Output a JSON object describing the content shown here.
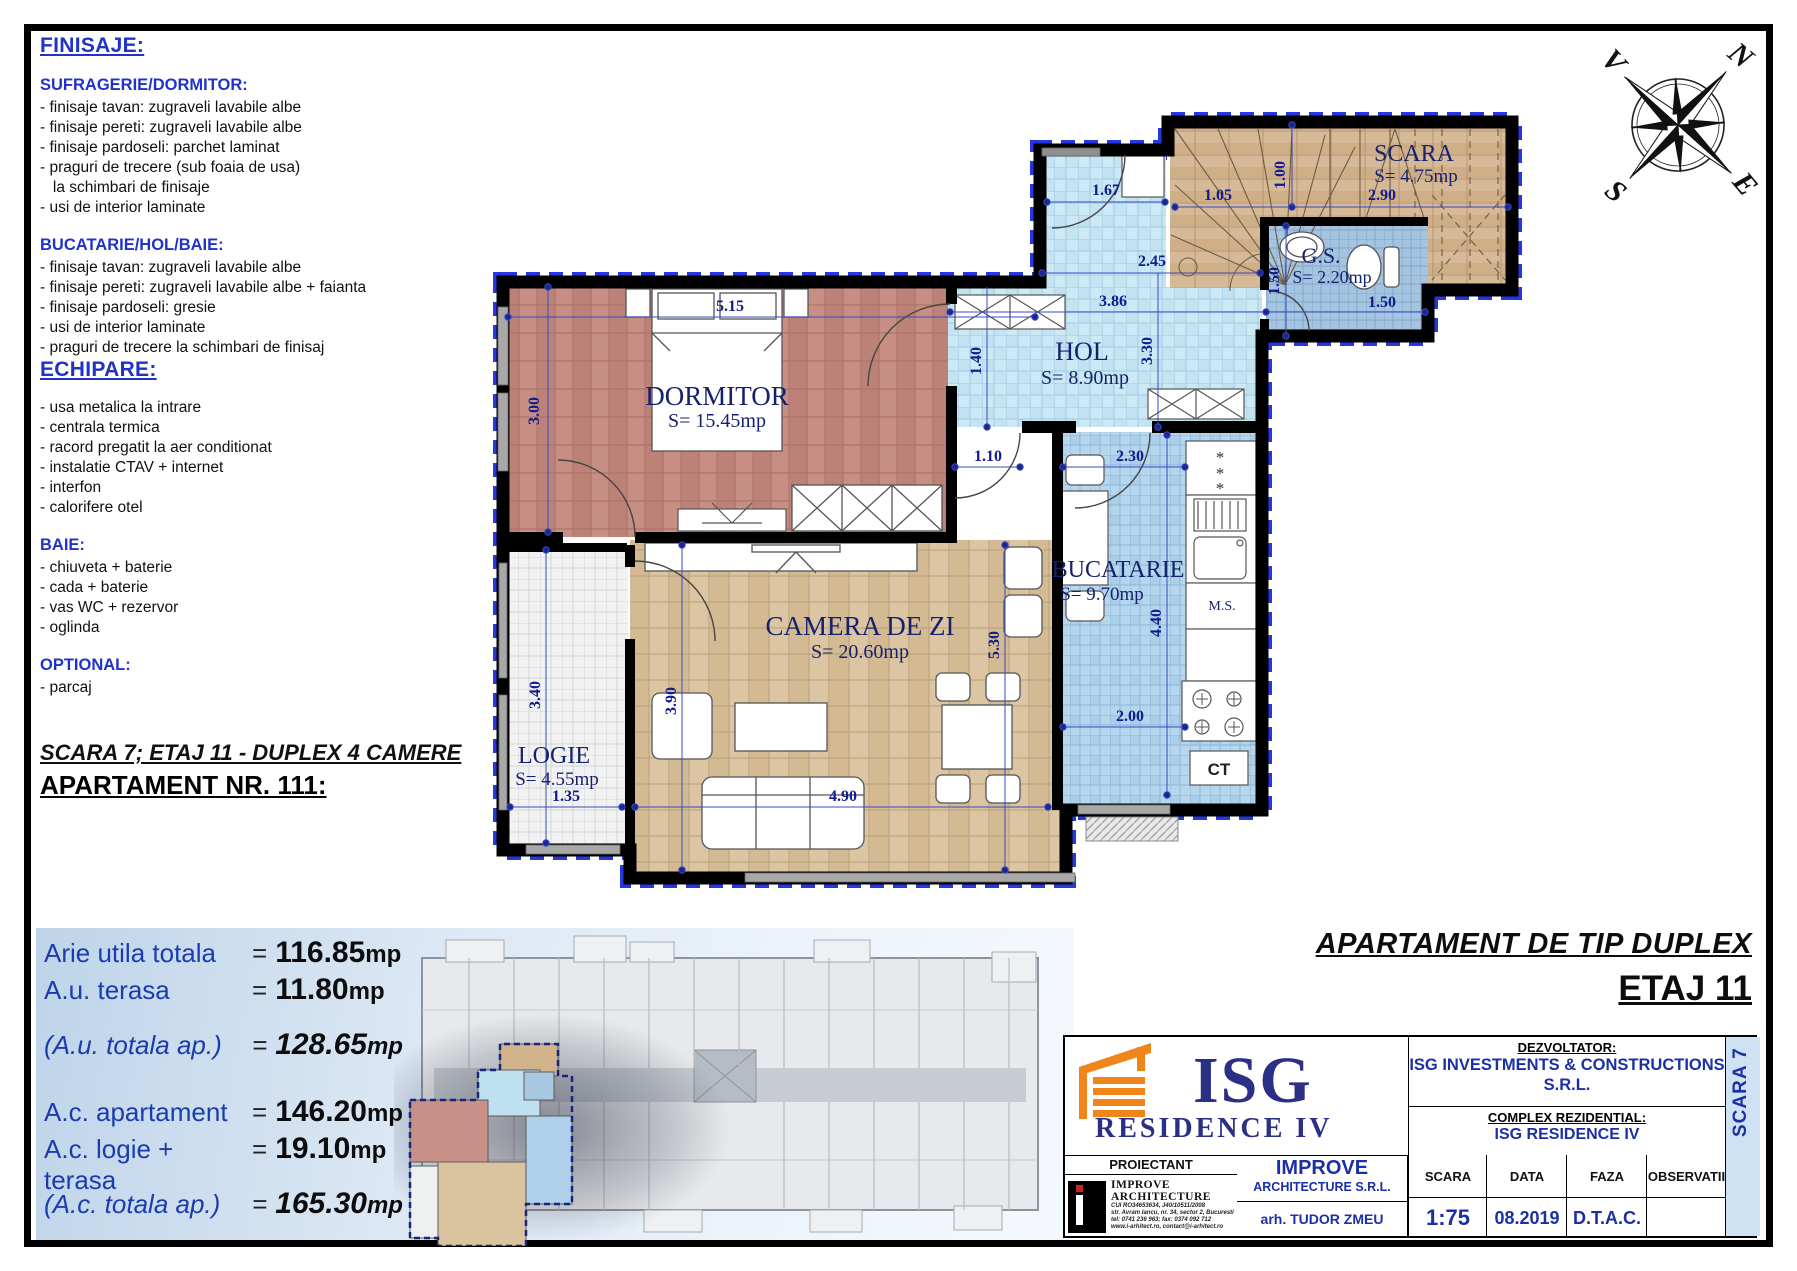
{
  "specs": {
    "finisaje_title": "FINISAJE:",
    "sections": [
      {
        "heading": "SUFRAGERIE/DORMITOR:",
        "items": [
          "- finisaje tavan: zugraveli lavabile albe",
          "- finisaje pereti: zugraveli lavabile albe",
          "- finisaje pardoseli: parchet laminat",
          "- praguri de trecere (sub foaia de usa)",
          "   la schimbari de finisaje",
          "- usi de interior laminate"
        ]
      },
      {
        "heading": "BUCATARIE/HOL/BAIE:",
        "items": [
          "- finisaje tavan: zugraveli lavabile albe",
          "- finisaje pereti: zugraveli lavabile albe + faianta",
          "- finisaje pardoseli: gresie",
          "- usi de interior laminate",
          "- praguri de trecere la schimbari de finisaj"
        ]
      }
    ],
    "echipare_title": "ECHIPARE:",
    "echipare_items": [
      "- usa metalica la intrare",
      "- centrala termica",
      "- racord pregatit la aer conditionat",
      "- instalatie CTAV + internet",
      "- interfon",
      "- calorifere otel"
    ],
    "baie_heading": "BAIE:",
    "baie_items": [
      "- chiuveta + baterie",
      "- cada + baterie",
      "- vas WC + rezervor",
      "- oglinda"
    ],
    "optional_heading": "OPTIONAL:",
    "optional_items": [
      "- parcaj"
    ]
  },
  "apartment": {
    "scara_line": "SCARA 7; ETAJ 11 - DUPLEX 4 CAMERE",
    "title": "APARTAMENT NR. 111:"
  },
  "areas": {
    "rows": [
      {
        "label": "Arie utila totala",
        "eq": "=",
        "value": "116.85",
        "unit": "mp",
        "cls": ""
      },
      {
        "label": "A.u. terasa",
        "eq": "=",
        "value": "11.80",
        "unit": "mp",
        "cls": ""
      },
      {
        "label": "(A.u. totala ap.)",
        "eq": "=",
        "value": "128.65",
        "unit": "mp",
        "cls": "italic gap"
      },
      {
        "label": "A.c. apartament",
        "eq": "=",
        "value": "146.20",
        "unit": "mp",
        "cls": "bgap"
      },
      {
        "label": "A.c. logie + terasa",
        "eq": "=",
        "value": "19.10",
        "unit": "mp",
        "cls": ""
      },
      {
        "label": "(A.c. totala ap.)",
        "eq": "=",
        "value": "165.30",
        "unit": "mp",
        "cls": "italic gap"
      }
    ]
  },
  "header_right": {
    "type_line": "APARTAMENT DE TIP DUPLEX",
    "etaj_line": "ETAJ 11"
  },
  "plan": {
    "rooms": {
      "dormitor": {
        "name": "DORMITOR",
        "area": "S= 15.45mp"
      },
      "camera": {
        "name": "CAMERA DE ZI",
        "area": "S= 20.60mp"
      },
      "bucatarie": {
        "name": "BUCATARIE",
        "area": "S= 9.70mp"
      },
      "hol": {
        "name": "HOL",
        "area": "S= 8.90mp"
      },
      "scara": {
        "name": "SCARA",
        "area": "S= 4.75mp"
      },
      "gs": {
        "name": "G.S.",
        "area": "S= 2.20mp"
      },
      "logie": {
        "name": "LOGIE",
        "area": "S= 4.55mp"
      }
    },
    "labels": {
      "ms": "M.S.",
      "ct": "CT"
    },
    "dims": {
      "d515": "5.15",
      "d300": "3.00",
      "d167": "1.67",
      "d245": "2.45",
      "d105": "1.05",
      "d100": "1.00",
      "d290": "2.90",
      "d150a": "1.50",
      "d150b": "1.50",
      "d386": "3.86",
      "d330": "3.30",
      "d140": "1.40",
      "d110": "1.10",
      "d230": "2.30",
      "d440": "4.40",
      "d530": "5.30",
      "d200": "2.00",
      "d390": "3.90",
      "d490": "4.90",
      "d340": "3.40",
      "d135": "1.35"
    }
  },
  "compass": {
    "n": "N",
    "e": "E",
    "s": "S",
    "v": "V"
  },
  "titleblock": {
    "logo_isg": "ISG",
    "logo_isg_sub": "RESIDENCE IV",
    "proiectant_label": "PROIECTANT",
    "improve_logo_title": "IMPROVE ARCHITECTURE",
    "improve_lines": [
      "CUI RO34653634, J40/10511/2008",
      "str. Avram Iancu, nr. 34, sector 2, Bucuresti",
      "tel: 0741 236 963; fax: 0374 092 712",
      "www.i-arhitect.ro, contact@i-arhitect.ro"
    ],
    "improve_name": "IMPROVE",
    "improve_sub": "ARCHITECTURE S.R.L.",
    "architect": "arh. TUDOR ZMEU",
    "dezvoltator_label": "DEZVOLTATOR:",
    "dezvoltator_name": "ISG INVESTMENTS & CONSTRUCTIONS",
    "dezvoltator_suffix": "S.R.L.",
    "complex_label": "COMPLEX REZIDENTIAL:",
    "complex_name": "ISG RESIDENCE IV",
    "cols": [
      {
        "h": "SCARA",
        "v": "1:75"
      },
      {
        "h": "DATA",
        "v": "08.2019"
      },
      {
        "h": "FAZA",
        "v": "D.T.A.C."
      },
      {
        "h": "OBSERVATII",
        "v": ""
      }
    ],
    "scara_strip": "SCARA 7"
  }
}
